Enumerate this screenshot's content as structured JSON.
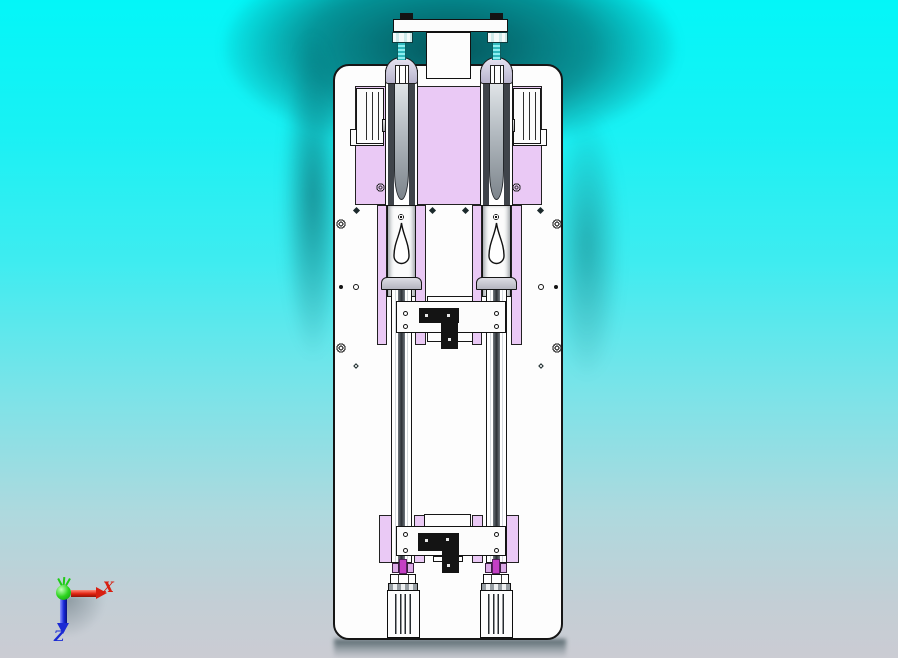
{
  "viewport": {
    "description": "3D CAD front view of a twin-cylinder press assembly mounted on a white base plate",
    "background_top_color": "#03f6f8",
    "background_bottom_color": "#cbccd3",
    "shadow_color": "#04464c"
  },
  "triad": {
    "x_label": "X",
    "x_color": "#d81f10",
    "z_label": "Z",
    "z_color": "#1b2ad4",
    "origin_color": "#2ed520"
  },
  "model": {
    "plate_color": "#fdfdfd",
    "block_color": "#eac9f5",
    "piston_rod_color": "#c43fc4",
    "threaded_rod_color": "#4ad2d6",
    "cap_color": "#cdc9e0",
    "bracket_color": "#141414",
    "parts": [
      "base-plate",
      "top-mount-bar",
      "threaded-rods",
      "rod-end-caps",
      "guide-channels",
      "slide-guide-blocks",
      "purple-mount-blocks",
      "teardrop-followers",
      "upper-cross-bar",
      "lower-cross-bar",
      "t-brackets",
      "cylinder-bodies"
    ]
  }
}
